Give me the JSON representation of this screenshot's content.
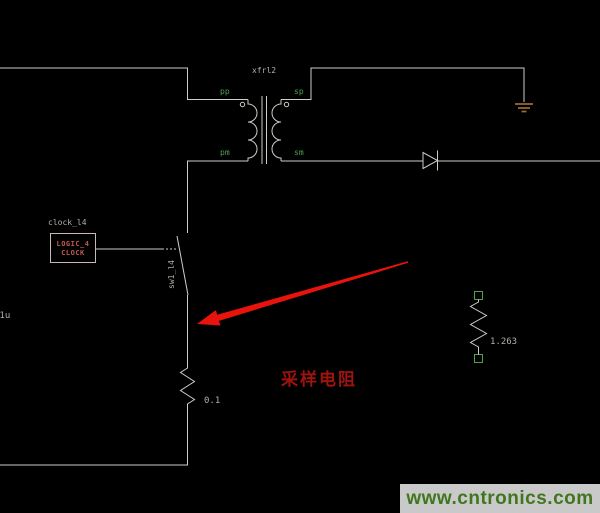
{
  "colors": {
    "background": "#000000",
    "wire": "#cfcdc6",
    "label_gray": "#b3afa6",
    "label_green": "#4ea24e",
    "instance_red": "#c05a50",
    "box_border": "#cbb6b6",
    "ground_brown": "#9a6a2e",
    "arrow_red": "#e8130c",
    "annotation_red": "#9e130e",
    "watermark_bg": "#c9c9c9",
    "watermark_green": "#41761e"
  },
  "schematic": {
    "transformer": {
      "name": "xfrl2",
      "pins": {
        "pp": "pp",
        "sp": "sp",
        "pm": "pm",
        "sm": "sm"
      }
    },
    "clock": {
      "instance": "clock_l4",
      "line1": "LOGIC_4",
      "line2": "CLOCK"
    },
    "switch": {
      "name": "sw1_l4"
    },
    "sense_resistor": {
      "value": "0.1"
    },
    "load_resistor": {
      "value": "1.263"
    },
    "partial_label": "01u",
    "annotation": "采样电阻"
  },
  "watermark": "www.cntronics.com"
}
